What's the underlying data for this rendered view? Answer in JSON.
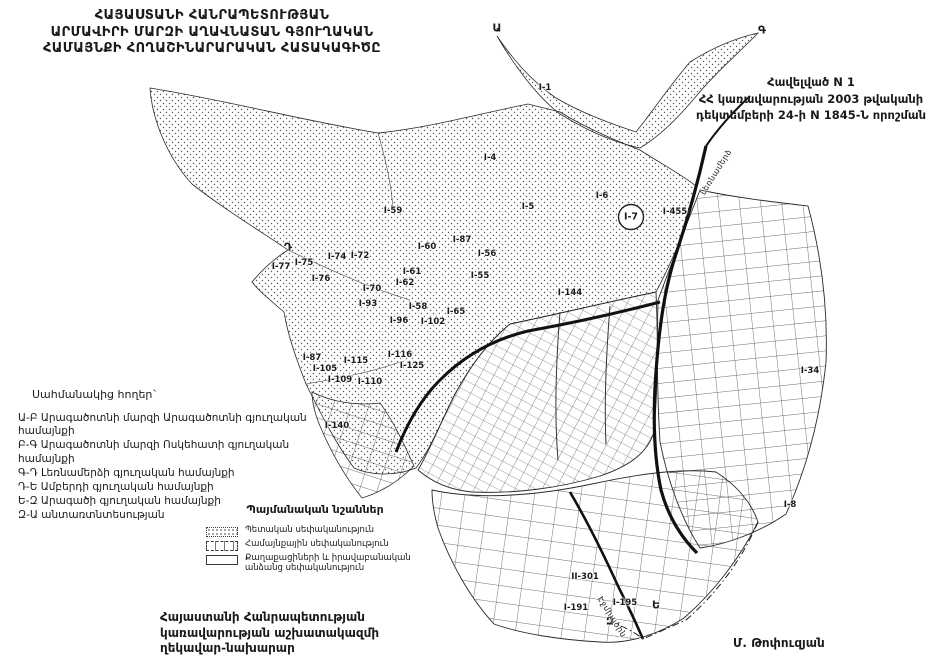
{
  "title": {
    "line1": "ՀԱՅԱՍՏԱՆԻ ՀԱՆՐԱՊԵՏՈՒԹՅԱՆ",
    "line2": "ԱՐՄԱՎԻՐԻ ՄԱՐԶԻ ԱՂԱՎՆԱՏԱՆ ԳՅՈՒՂԱԿԱՆ",
    "line3": "ՀԱՄԱՅՆՔԻ ՀՈՂԱՇԻՆԱՐԱՐԱԿԱՆ ՀԱՏԱԿԱԳԻԾԸ"
  },
  "annex": {
    "line1": "Հավելված N 1",
    "line2": "ՀՀ կառավարության 2003 թվականի",
    "line3": "դեկտեմբերի 24-ի N 1845-Ն որոշման"
  },
  "adjacent": {
    "heading": "Սահմանակից հողեր`",
    "items": [
      "Ա-Բ Արագածոտնի մարզի Արագածոտնի գյուղական համայնքի",
      "Բ-Գ Արագածոտնի մարզի Ոսկեհատի գյուղական համայնքի",
      "Գ-Դ Լեռնամերձի գյուղական համայնքի",
      "Դ-Ե Ամբերդի գյուղական համայնքի",
      "Ե-Զ Արագածի գյուղական համայնքի",
      "Զ-Ա անտառտնտեսության"
    ]
  },
  "legend": {
    "heading": "Պայմանական նշաններ",
    "items": [
      {
        "swatch": "stipple",
        "label": "Պետական սեփականություն"
      },
      {
        "swatch": "hatch",
        "label": "Համայնքային սեփականություն"
      },
      {
        "swatch": "plain",
        "label": "Քաղաքացիների և իրավաբանական անձանց սեփականություն"
      }
    ]
  },
  "signoff": {
    "line1": "Հայաստանի Հանրապետության",
    "line2": "կառավարության աշխատակազմի",
    "line3": "ղեկավար-նախարար",
    "name": "Մ. Թոփուզյան"
  },
  "map": {
    "ink": "#1c1c1c",
    "parcel_labels": [
      {
        "id": "I-1",
        "x": 545,
        "y": 88
      },
      {
        "id": "I-4",
        "x": 490,
        "y": 158
      },
      {
        "id": "I-5",
        "x": 528,
        "y": 207
      },
      {
        "id": "I-6",
        "x": 602,
        "y": 196
      },
      {
        "id": "I-59",
        "x": 393,
        "y": 211
      },
      {
        "id": "I-87",
        "x": 462,
        "y": 240
      },
      {
        "id": "I-60",
        "x": 427,
        "y": 247
      },
      {
        "id": "I-56",
        "x": 487,
        "y": 254
      },
      {
        "id": "I-55",
        "x": 480,
        "y": 276
      },
      {
        "id": "I-61",
        "x": 412,
        "y": 272
      },
      {
        "id": "I-62",
        "x": 405,
        "y": 283
      },
      {
        "id": "I-77",
        "x": 281,
        "y": 267
      },
      {
        "id": "I-75",
        "x": 304,
        "y": 263
      },
      {
        "id": "I-74",
        "x": 337,
        "y": 257
      },
      {
        "id": "I-72",
        "x": 360,
        "y": 256
      },
      {
        "id": "I-76",
        "x": 321,
        "y": 279
      },
      {
        "id": "I-70",
        "x": 372,
        "y": 289
      },
      {
        "id": "I-93",
        "x": 368,
        "y": 304
      },
      {
        "id": "I-58",
        "x": 418,
        "y": 307
      },
      {
        "id": "I-65",
        "x": 456,
        "y": 312
      },
      {
        "id": "I-96",
        "x": 399,
        "y": 321
      },
      {
        "id": "I-102",
        "x": 433,
        "y": 322
      },
      {
        "id": "I-87",
        "x": 312,
        "y": 358
      },
      {
        "id": "I-105",
        "x": 325,
        "y": 369
      },
      {
        "id": "I-109",
        "x": 340,
        "y": 380
      },
      {
        "id": "I-115",
        "x": 356,
        "y": 361
      },
      {
        "id": "I-116",
        "x": 400,
        "y": 355
      },
      {
        "id": "I-125",
        "x": 412,
        "y": 366
      },
      {
        "id": "I-110",
        "x": 370,
        "y": 382
      },
      {
        "id": "I-140",
        "x": 337,
        "y": 426
      },
      {
        "id": "I-144",
        "x": 570,
        "y": 293
      },
      {
        "id": "I-455",
        "x": 675,
        "y": 212
      },
      {
        "id": "I-34",
        "x": 810,
        "y": 371
      },
      {
        "id": "I-8",
        "x": 790,
        "y": 505
      },
      {
        "id": "II-301",
        "x": 585,
        "y": 577
      },
      {
        "id": "I-191",
        "x": 576,
        "y": 608
      },
      {
        "id": "I-195",
        "x": 625,
        "y": 603
      }
    ],
    "circled_label": {
      "id": "I-7",
      "x": 631,
      "y": 217
    },
    "boundary_points": [
      {
        "id": "Ա",
        "x": 497,
        "y": 28
      },
      {
        "id": "Գ",
        "x": 762,
        "y": 30
      },
      {
        "id": "Դ",
        "x": 288,
        "y": 247
      },
      {
        "id": "Ե",
        "x": 656,
        "y": 605
      },
      {
        "id": "Զ",
        "x": 610,
        "y": 621
      }
    ],
    "road_labels": [
      {
        "text": "Լեռնամերձ",
        "x": 716,
        "y": 172,
        "rotate": -58
      },
      {
        "text": "Էջմիածին",
        "x": 612,
        "y": 617,
        "rotate": 58
      }
    ]
  }
}
